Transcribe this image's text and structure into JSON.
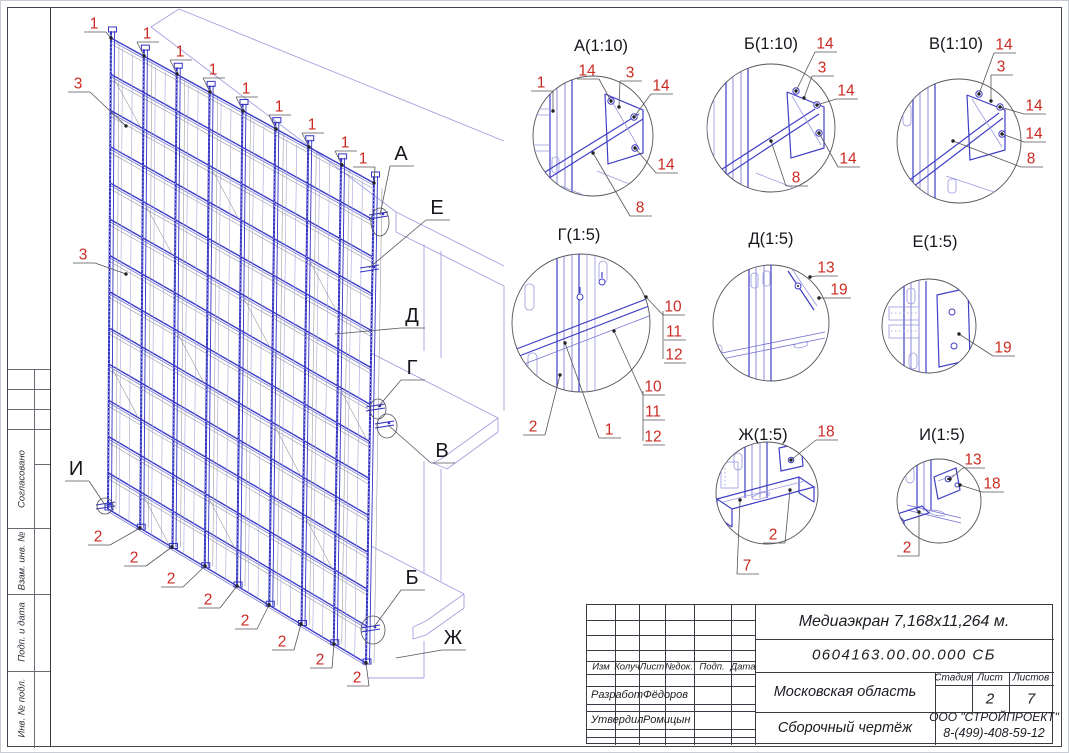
{
  "colors": {
    "callout_red": "#cb2a22",
    "frame_blue": "#3c3cc8",
    "light_blue": "#9a98de",
    "building_outline": "#a3a0e0",
    "line_dark": "#3a3a42"
  },
  "sidebar": {
    "labels": [
      "Согласовано",
      "Взам. инв. №",
      "Подп. и дата",
      "Инв. № подл."
    ]
  },
  "main_view": {
    "position_callouts": [
      {
        "label": "1",
        "x": 93,
        "y": 22,
        "tx": 110,
        "ty": 37
      },
      {
        "label": "1",
        "x": 146,
        "y": 32,
        "tx": 143,
        "ty": 55
      },
      {
        "label": "1",
        "x": 179,
        "y": 50,
        "tx": 176,
        "ty": 73
      },
      {
        "label": "1",
        "x": 212,
        "y": 68,
        "tx": 209,
        "ty": 91
      },
      {
        "label": "1",
        "x": 245,
        "y": 87,
        "tx": 242,
        "ty": 110
      },
      {
        "label": "1",
        "x": 278,
        "y": 105,
        "tx": 275,
        "ty": 128
      },
      {
        "label": "1",
        "x": 311,
        "y": 123,
        "tx": 308,
        "ty": 146
      },
      {
        "label": "1",
        "x": 344,
        "y": 141,
        "tx": 341,
        "ty": 164
      },
      {
        "label": "1",
        "x": 362,
        "y": 157,
        "tx": 373,
        "ty": 182
      },
      {
        "label": "3",
        "x": 77,
        "y": 82,
        "tx": 125,
        "ty": 125
      },
      {
        "label": "3",
        "x": 82,
        "y": 253,
        "tx": 125,
        "ty": 273
      },
      {
        "label": "2",
        "x": 97,
        "y": 535,
        "tx": 139,
        "ty": 527
      },
      {
        "label": "2",
        "x": 133,
        "y": 556,
        "tx": 171,
        "ty": 546
      },
      {
        "label": "2",
        "x": 170,
        "y": 577,
        "tx": 204,
        "ty": 565
      },
      {
        "label": "2",
        "x": 207,
        "y": 598,
        "tx": 236,
        "ty": 585
      },
      {
        "label": "2",
        "x": 244,
        "y": 619,
        "tx": 268,
        "ty": 604
      },
      {
        "label": "2",
        "x": 281,
        "y": 640,
        "tx": 300,
        "ty": 623
      },
      {
        "label": "2",
        "x": 319,
        "y": 658,
        "tx": 333,
        "ty": 643
      },
      {
        "label": "2",
        "x": 356,
        "y": 676,
        "tx": 365,
        "ty": 662
      }
    ],
    "view_letters": [
      {
        "label": "А",
        "x": 400,
        "y": 152,
        "tx": 379,
        "ty": 214
      },
      {
        "label": "Е",
        "x": 436,
        "y": 206,
        "tx": 368,
        "ty": 267
      },
      {
        "label": "Д",
        "x": 411,
        "y": 314,
        "tx": 334,
        "ty": 333
      },
      {
        "label": "Г",
        "x": 411,
        "y": 366,
        "tx": 377,
        "ty": 406
      },
      {
        "label": "В",
        "x": 441,
        "y": 449,
        "tx": 387,
        "ty": 424
      },
      {
        "label": "И",
        "x": 75,
        "y": 467,
        "tx": 104,
        "ty": 504
      },
      {
        "label": "Б",
        "x": 411,
        "y": 576,
        "tx": 373,
        "ty": 626
      },
      {
        "label": "Ж",
        "x": 452,
        "y": 636,
        "tx": 395,
        "ty": 657
      }
    ]
  },
  "details": [
    {
      "title": "А(1:10)",
      "x": 600,
      "y": 44,
      "callouts": [
        {
          "label": "1",
          "x": 540,
          "y": 81,
          "tx": 552,
          "ty": 110
        },
        {
          "label": "14",
          "x": 586,
          "y": 69,
          "tx": 610,
          "ty": 100
        },
        {
          "label": "3",
          "x": 629,
          "y": 71,
          "tx": 618,
          "ty": 106
        },
        {
          "label": "14",
          "x": 660,
          "y": 84,
          "tx": 633,
          "ty": 116
        },
        {
          "label": "14",
          "x": 665,
          "y": 163,
          "tx": 634,
          "ty": 147
        },
        {
          "label": "8",
          "x": 639,
          "y": 206,
          "tx": 592,
          "ty": 152
        }
      ]
    },
    {
      "title": "Б(1:10)",
      "x": 770,
      "y": 42,
      "callouts": [
        {
          "label": "14",
          "x": 824,
          "y": 42,
          "tx": 795,
          "ty": 90
        },
        {
          "label": "3",
          "x": 821,
          "y": 66,
          "tx": 803,
          "ty": 97
        },
        {
          "label": "14",
          "x": 845,
          "y": 89,
          "tx": 816,
          "ty": 104
        },
        {
          "label": "14",
          "x": 847,
          "y": 157,
          "tx": 818,
          "ty": 132
        },
        {
          "label": "8",
          "x": 795,
          "y": 176,
          "tx": 770,
          "ty": 140
        }
      ]
    },
    {
      "title": "В(1:10)",
      "x": 955,
      "y": 42,
      "callouts": [
        {
          "label": "14",
          "x": 1003,
          "y": 43,
          "tx": 978,
          "ty": 93
        },
        {
          "label": "3",
          "x": 1000,
          "y": 65,
          "tx": 990,
          "ty": 100
        },
        {
          "label": "14",
          "x": 1033,
          "y": 104,
          "tx": 999,
          "ty": 106
        },
        {
          "label": "14",
          "x": 1033,
          "y": 132,
          "tx": 1001,
          "ty": 133
        },
        {
          "label": "8",
          "x": 1030,
          "y": 157,
          "tx": 952,
          "ty": 140
        }
      ]
    },
    {
      "title": "Г(1:5)",
      "x": 578,
      "y": 233,
      "callouts": [
        {
          "label": "10",
          "x": 672,
          "y": 305,
          "tx": 645,
          "ty": 296
        },
        {
          "label": "11",
          "x": 673,
          "y": 330
        },
        {
          "label": "12",
          "x": 673,
          "y": 353
        },
        {
          "label": "10",
          "x": 652,
          "y": 385,
          "tx": 613,
          "ty": 330
        },
        {
          "label": "11",
          "x": 652,
          "y": 410
        },
        {
          "label": "12",
          "x": 652,
          "y": 435
        },
        {
          "label": "2",
          "x": 532,
          "y": 425,
          "tx": 559,
          "ty": 374
        },
        {
          "label": "1",
          "x": 608,
          "y": 428,
          "tx": 564,
          "ty": 342
        }
      ]
    },
    {
      "title": "Д(1:5)",
      "x": 770,
      "y": 237,
      "callouts": [
        {
          "label": "13",
          "x": 825,
          "y": 266,
          "tx": 809,
          "ty": 276
        },
        {
          "label": "19",
          "x": 838,
          "y": 288,
          "tx": 818,
          "ty": 297
        }
      ]
    },
    {
      "title": "Е(1:5)",
      "x": 934,
      "y": 240,
      "callouts": [
        {
          "label": "19",
          "x": 1002,
          "y": 346,
          "tx": 958,
          "ty": 333
        }
      ]
    },
    {
      "title": "Ж(1:5)",
      "x": 762,
      "y": 433,
      "callouts": [
        {
          "label": "18",
          "x": 825,
          "y": 430,
          "tx": 790,
          "ty": 459
        },
        {
          "label": "2",
          "x": 772,
          "y": 533,
          "tx": 789,
          "ty": 489
        },
        {
          "label": "7",
          "x": 746,
          "y": 564,
          "tx": 739,
          "ty": 499
        }
      ]
    },
    {
      "title": "И(1:5)",
      "x": 941,
      "y": 433,
      "callouts": [
        {
          "label": "13",
          "x": 972,
          "y": 458,
          "tx": 949,
          "ty": 478
        },
        {
          "label": "18",
          "x": 991,
          "y": 482,
          "tx": 959,
          "ty": 484
        },
        {
          "label": "2",
          "x": 906,
          "y": 546,
          "tx": 918,
          "ty": 511
        }
      ]
    }
  ],
  "title_block": {
    "doc_title": "Медиаэкран 7,168x11,264 м.",
    "doc_number": "0604163.00.00.000 СБ",
    "region": "Московская область",
    "drawing_type": "Сборочный чертёж",
    "company": "ООО \"СТРОЙПРОЕКТ\"",
    "phone": "8-(499)-408-59-12",
    "stage_header": "Стадия",
    "sheet_header": "Лист",
    "sheets_header": "Листов",
    "sheet_number": "2",
    "sheets_total": "7",
    "columns": [
      "Изм",
      "Колуч",
      "Лист",
      "№док.",
      "Подп.",
      "Дата"
    ],
    "rows": [
      {
        "role": "Разработ",
        "name": "Фёдоров"
      },
      {
        "role": "Утвердил",
        "name": "Ромицын"
      }
    ]
  }
}
